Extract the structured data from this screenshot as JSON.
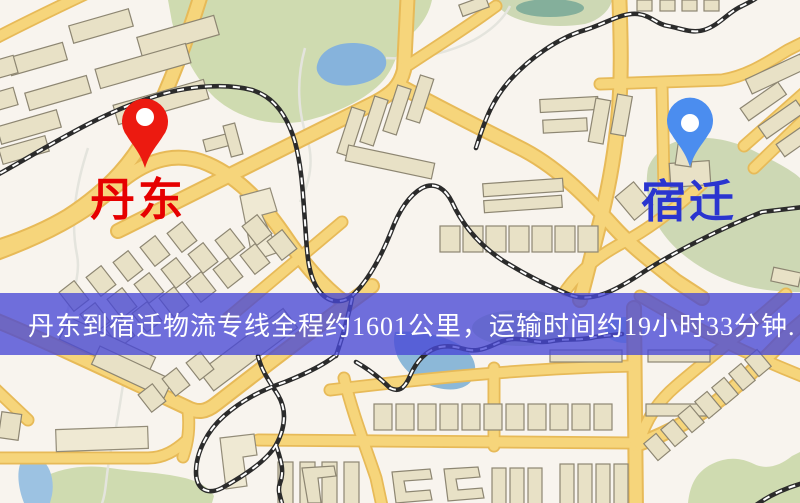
{
  "map": {
    "origin_marker": {
      "label": "丹东",
      "pin_color": "#ec1a10",
      "label_color": "#e60000"
    },
    "destination_marker": {
      "label": "宿迁",
      "pin_color": "#4b8def",
      "label_color": "#2a35cf"
    },
    "info_banner": {
      "text": "丹东到宿迁物流专线全程约1601公里，运输时间约19小时33分钟.",
      "background": "#4848d6",
      "text_color": "#ffffff"
    },
    "theme_colors": {
      "base": "#f8f4ee",
      "road": "#f6d57b",
      "road_casing": "#e7ba58",
      "park": "#cfdbb0",
      "water": "#86b3dc",
      "railway": "#2b2b2b",
      "building": "#e8e1c6"
    }
  }
}
